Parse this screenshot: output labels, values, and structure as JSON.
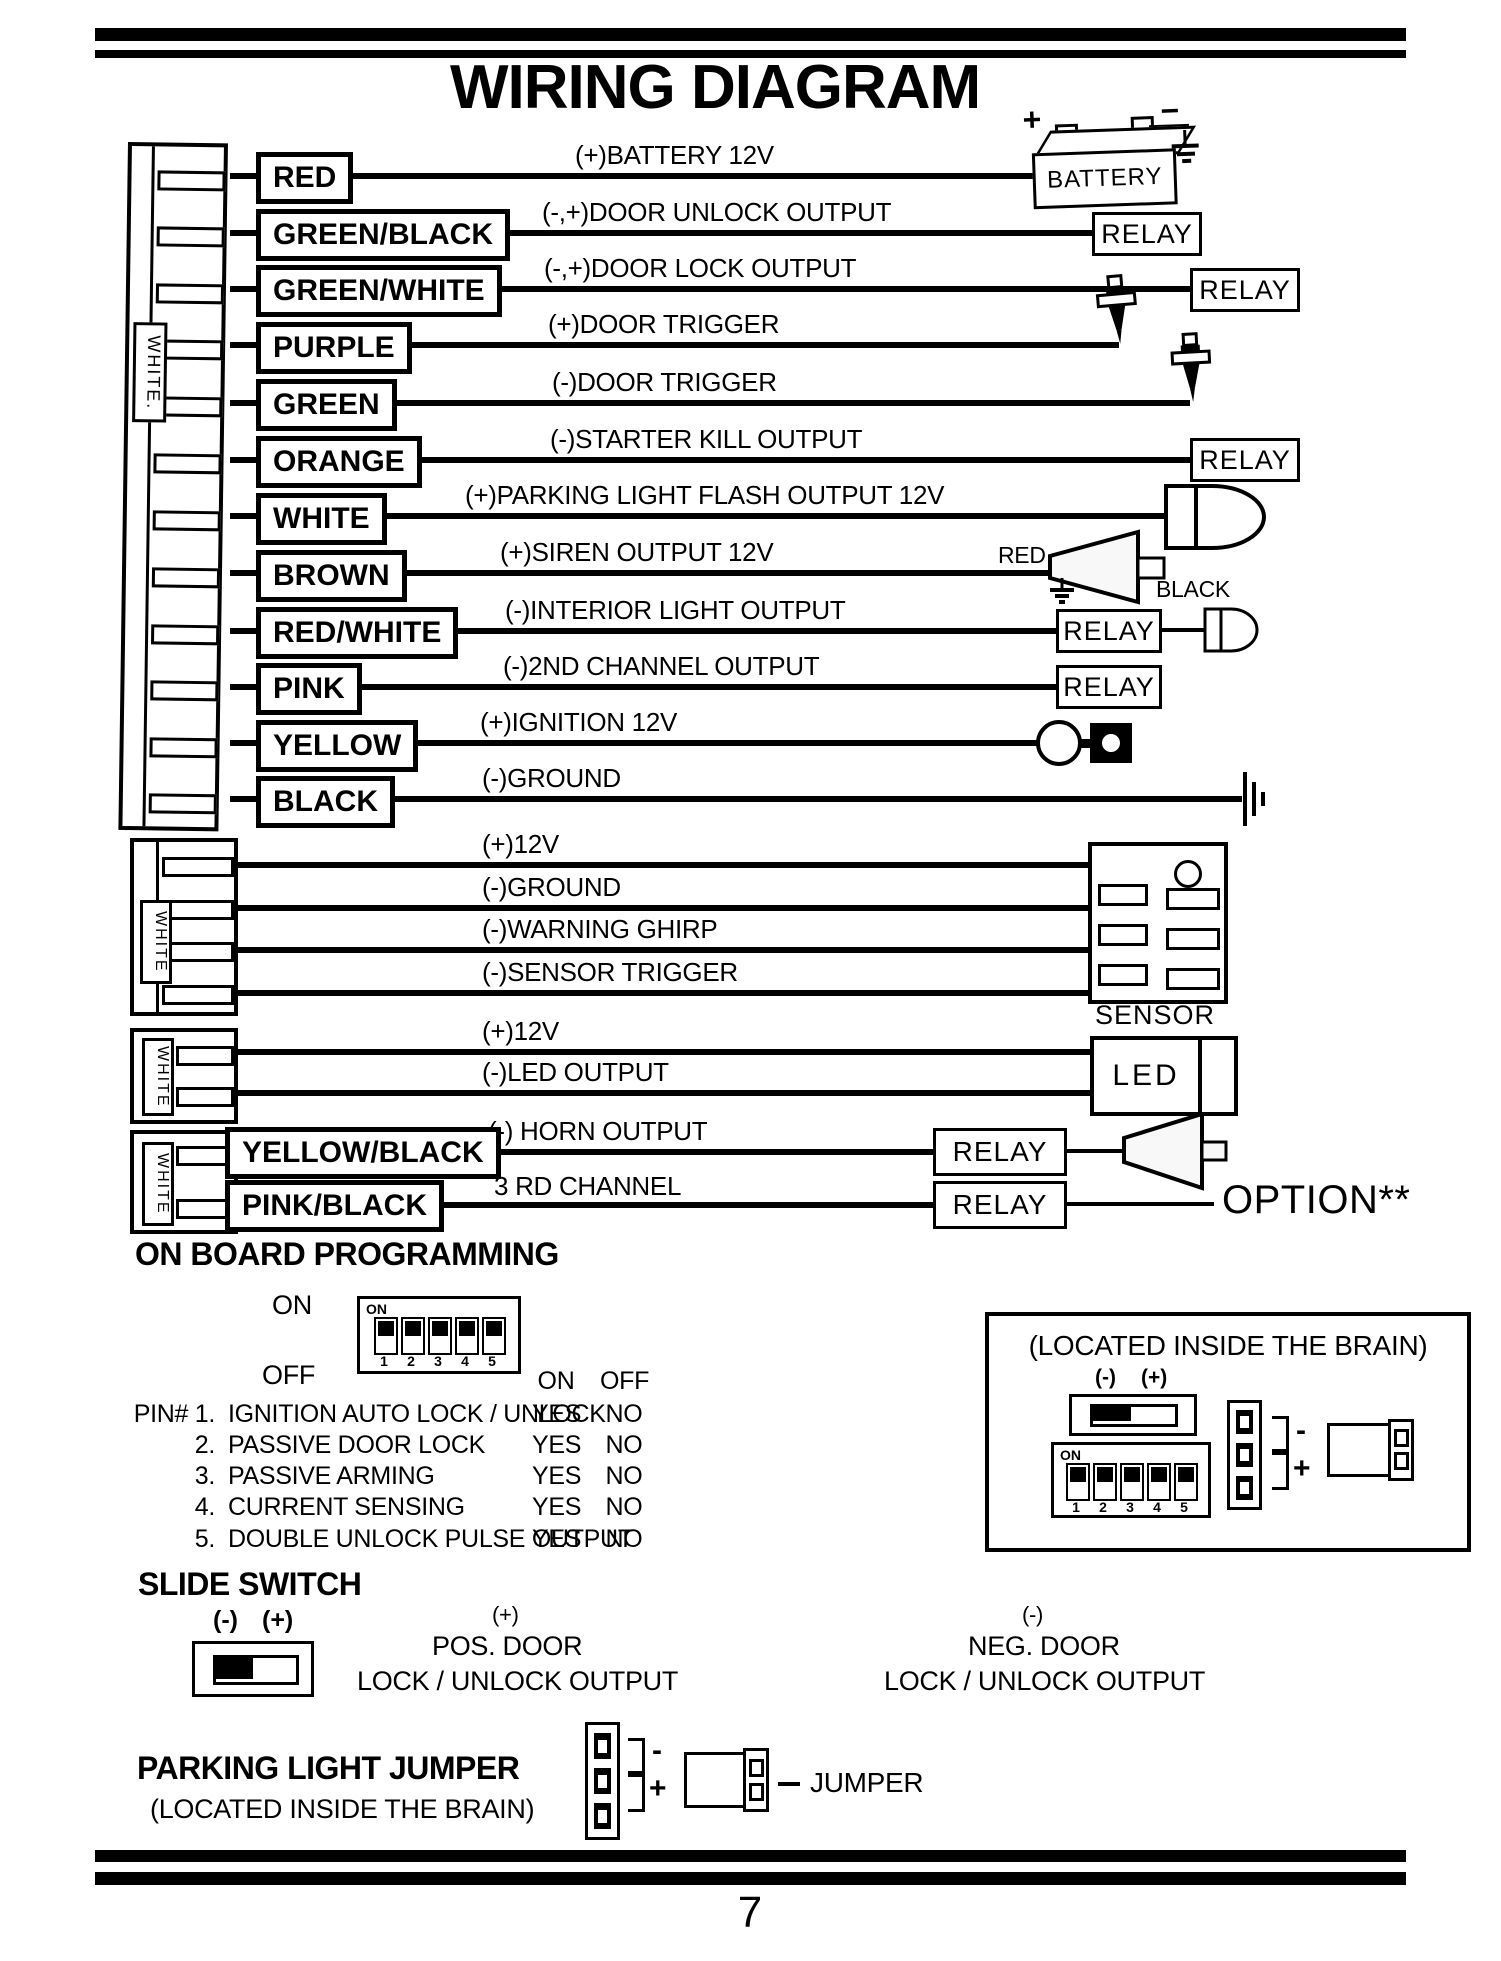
{
  "title": "WIRING DIAGRAM",
  "page": {
    "number": "7"
  },
  "components": {
    "relay": "RELAY",
    "battery": "BATTERY",
    "battery_plus": "+",
    "battery_minus": "−",
    "sensor": "SENSOR",
    "led": "LED",
    "option": "OPTION**",
    "siren_red": "RED",
    "siren_black": "BLACK"
  },
  "connectors": {
    "main": "WHITE.",
    "sensor": "WHITE",
    "led": "WHITE",
    "horn": "WHITE"
  },
  "wires": [
    {
      "color": "RED",
      "label": "(+)BATTERY 12V"
    },
    {
      "color": "GREEN/BLACK",
      "label": "(-,+)DOOR UNLOCK OUTPUT"
    },
    {
      "color": "GREEN/WHITE",
      "label": "(-,+)DOOR LOCK OUTPUT"
    },
    {
      "color": "PURPLE",
      "label": "(+)DOOR TRIGGER"
    },
    {
      "color": "GREEN",
      "label": "(-)DOOR TRIGGER"
    },
    {
      "color": "ORANGE",
      "label": "(-)STARTER KILL OUTPUT"
    },
    {
      "color": "WHITE",
      "label": "(+)PARKING LIGHT FLASH OUTPUT 12V"
    },
    {
      "color": "BROWN",
      "label": "(+)SIREN OUTPUT 12V"
    },
    {
      "color": "RED/WHITE",
      "label": "(-)INTERIOR LIGHT OUTPUT"
    },
    {
      "color": "PINK",
      "label": "(-)2ND CHANNEL OUTPUT"
    },
    {
      "color": "YELLOW",
      "label": "(+)IGNITION 12V"
    },
    {
      "color": "BLACK",
      "label": "(-)GROUND"
    }
  ],
  "sensor_section": {
    "wires": [
      "(+)12V",
      "(-)GROUND",
      "(-)WARNING GHIRP",
      "(-)SENSOR TRIGGER"
    ]
  },
  "led_section": {
    "wires": [
      "(+)12V",
      "(-)LED OUTPUT"
    ]
  },
  "horn_section": {
    "wires": [
      {
        "color": "YELLOW/BLACK",
        "label": "(-) HORN OUTPUT"
      },
      {
        "color": "PINK/BLACK",
        "label": "3 RD CHANNEL"
      }
    ]
  },
  "programming": {
    "heading": "ON BOARD PROGRAMMING",
    "on_label": "ON",
    "off_label": "OFF",
    "dip": {
      "on": "ON",
      "numbers": [
        "1",
        "2",
        "3",
        "4",
        "5"
      ]
    },
    "table": {
      "col_on": "ON",
      "col_off": "OFF",
      "rows": [
        {
          "num": "PIN# 1.",
          "label": "IGNITION AUTO LOCK / UNLOCK",
          "on": "YES",
          "off": "NO"
        },
        {
          "num": "2.",
          "label": "PASSIVE DOOR LOCK",
          "on": "YES",
          "off": "NO"
        },
        {
          "num": "3.",
          "label": "PASSIVE ARMING",
          "on": "YES",
          "off": "NO"
        },
        {
          "num": "4.",
          "label": "CURRENT SENSING",
          "on": "YES",
          "off": "NO"
        },
        {
          "num": "5.",
          "label": "DOUBLE UNLOCK PULSE OUTPUT",
          "on": "YES",
          "off": "NO"
        }
      ]
    },
    "brain": {
      "title": "(LOCATED INSIDE THE BRAIN)",
      "minus": "(-)",
      "plus": "(+)",
      "jumper_minus": "-",
      "jumper_plus": "+"
    }
  },
  "slide_switch": {
    "heading": "SLIDE SWITCH",
    "minus": "(-)",
    "plus": "(+)",
    "pos": {
      "sign": "(+)",
      "line1": "POS. DOOR",
      "line2": "LOCK / UNLOCK OUTPUT"
    },
    "neg": {
      "sign": "(-)",
      "line1": "NEG. DOOR",
      "line2": "LOCK / UNLOCK OUTPUT"
    }
  },
  "parking_jumper": {
    "heading": "PARKING LIGHT JUMPER",
    "subheading": "(LOCATED INSIDE THE BRAIN)",
    "minus": "-",
    "plus": "+",
    "label": "JUMPER"
  }
}
